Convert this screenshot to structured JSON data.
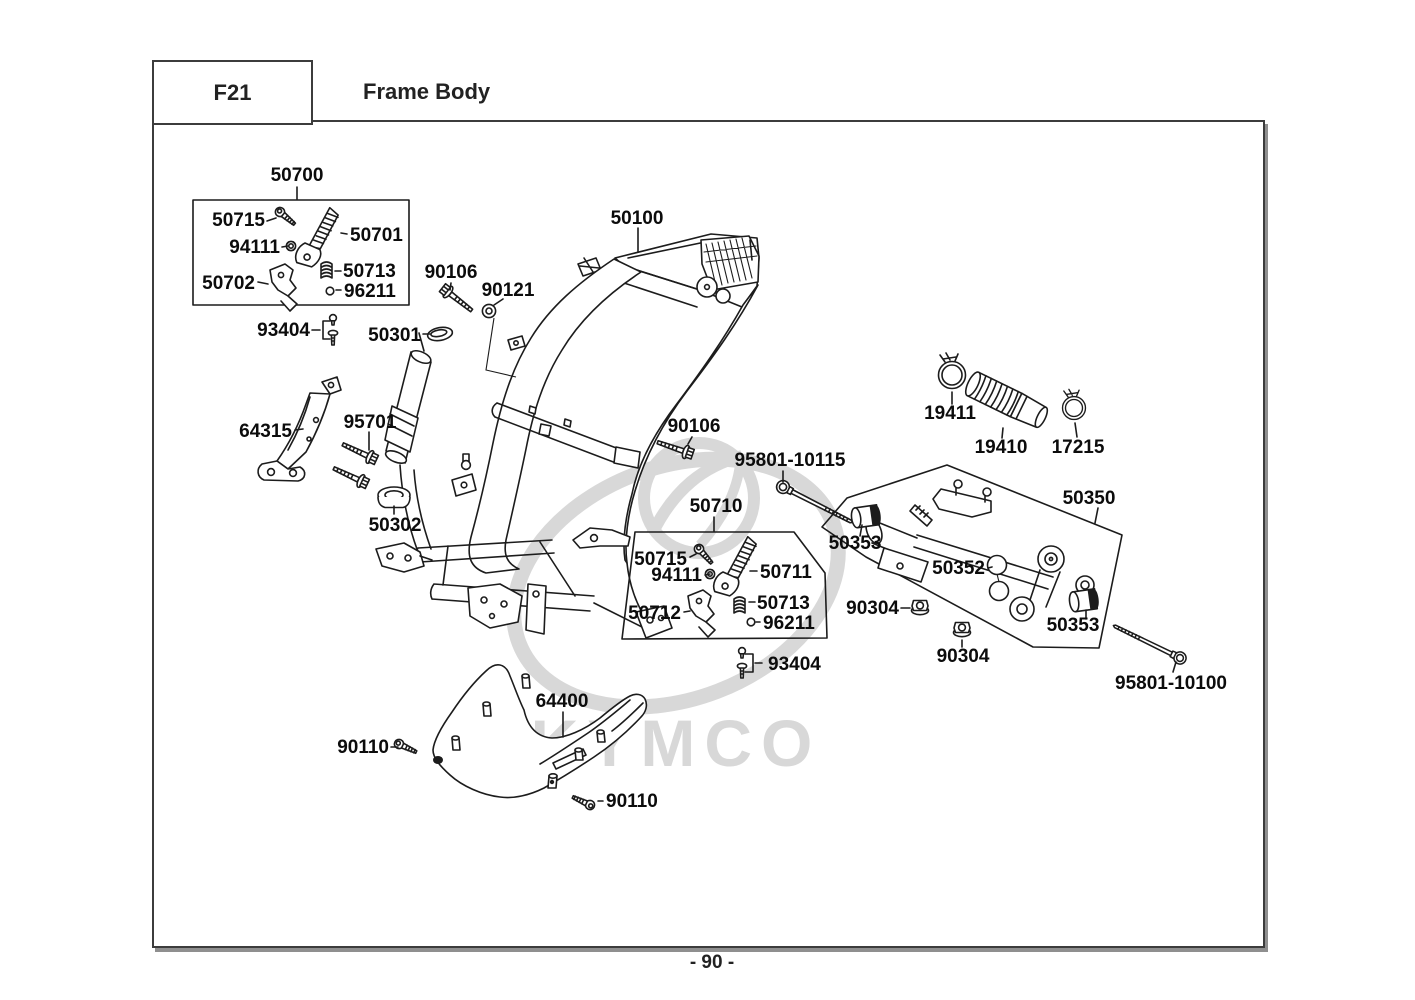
{
  "header": {
    "code": "F21",
    "title": "Frame Body"
  },
  "footer": {
    "page": "- 90 -"
  },
  "watermark": {
    "brand": "KYMCO"
  },
  "colors": {
    "line": "#1c1c1c",
    "label": "#0c0c0c",
    "watermark": "#d8d8d8",
    "border": "#3c3c3c"
  },
  "callouts": {
    "g50700": "50700",
    "s50715a": "50715",
    "n94111a": "94111",
    "a50701": "50701",
    "b50702": "50702",
    "sp50713a": "50713",
    "r96211a": "96211",
    "bt93404a": "93404",
    "c50301": "50301",
    "bo90106a": "90106",
    "gr90121": "90121",
    "f50100": "50100",
    "st64315": "64315",
    "bo95701": "95701",
    "gr50302": "50302",
    "bo90106b": "90106",
    "bl95801a": "95801-10115",
    "g50710": "50710",
    "s50715b": "50715",
    "n94111b": "94111",
    "a50711": "50711",
    "b50712": "50712",
    "sp50713b": "50713",
    "r96211b": "96211",
    "bt93404b": "93404",
    "cl19411": "19411",
    "d19410": "19410",
    "cl17215": "17215",
    "g50350": "50350",
    "bu50353a": "50353",
    "co50352": "50352",
    "nu90304a": "90304",
    "nu90304b": "90304",
    "bu50353b": "50353",
    "bl95801b": "95801-10100",
    "cv64400": "64400",
    "sc90110a": "90110",
    "sc90110b": "90110"
  }
}
